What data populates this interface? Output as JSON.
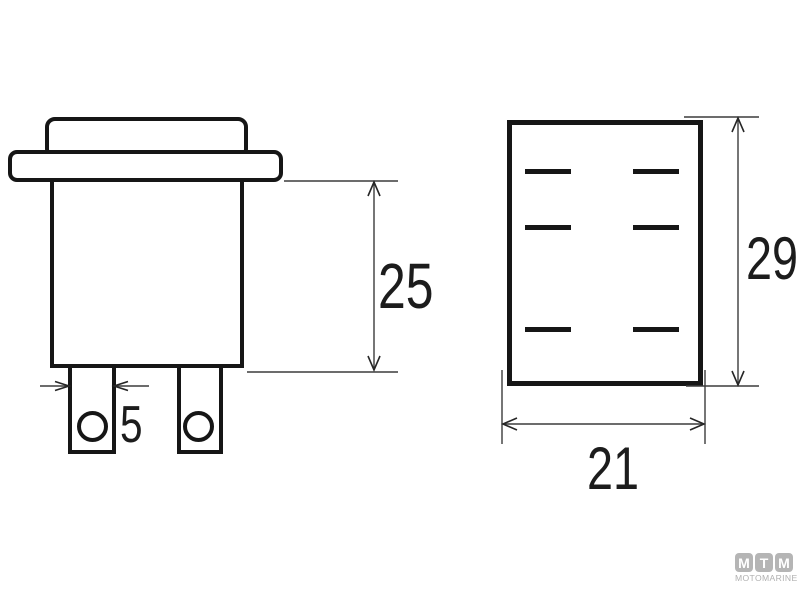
{
  "drawing": {
    "dimensions": {
      "side_height": "25",
      "terminal_width": "5",
      "rear_height": "29",
      "rear_width": "21"
    }
  },
  "logo": {
    "tiles": [
      "M",
      "T",
      "M"
    ],
    "subtitle": "MOTOMARINE",
    "tile_color": "#b5b5b5",
    "text_color": "#b0b0b0"
  },
  "colors": {
    "outline": "#161616",
    "dimension_lines": "#3c3c3c",
    "background": "#ffffff"
  }
}
